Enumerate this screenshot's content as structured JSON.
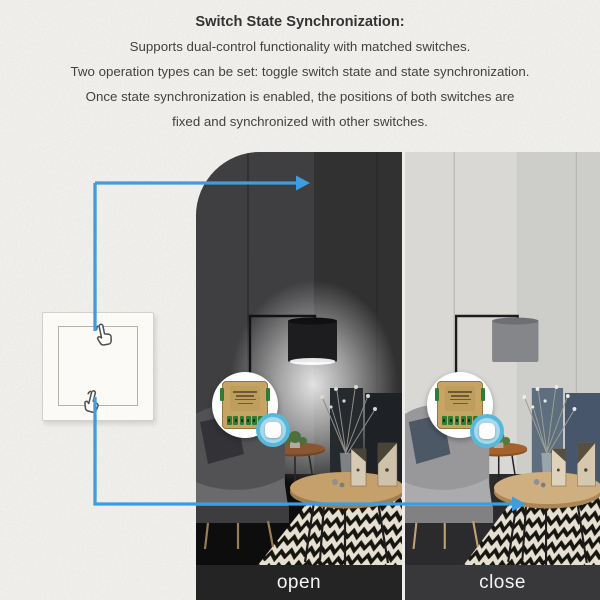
{
  "heading": {
    "title": "Switch State Synchronization:",
    "lines": [
      "Supports dual-control functionality with matched switches.",
      "Two operation types can be set: toggle switch state and state synchronization.",
      "Once state synchronization is enabled, the positions of both switches are",
      "fixed and synchronized with other switches."
    ]
  },
  "photos": [
    {
      "label": "open",
      "lamp_state": "on"
    },
    {
      "label": "close",
      "lamp_state": "off"
    }
  ],
  "colors": {
    "arrow_blue": "#3F9CDD",
    "module_gold": "#C7A465",
    "terminal_green": "#2F7D35",
    "switch_icon_blue": "#57B8DB",
    "caption_bar_open": "#242424",
    "caption_bar_close": "#38383B"
  }
}
